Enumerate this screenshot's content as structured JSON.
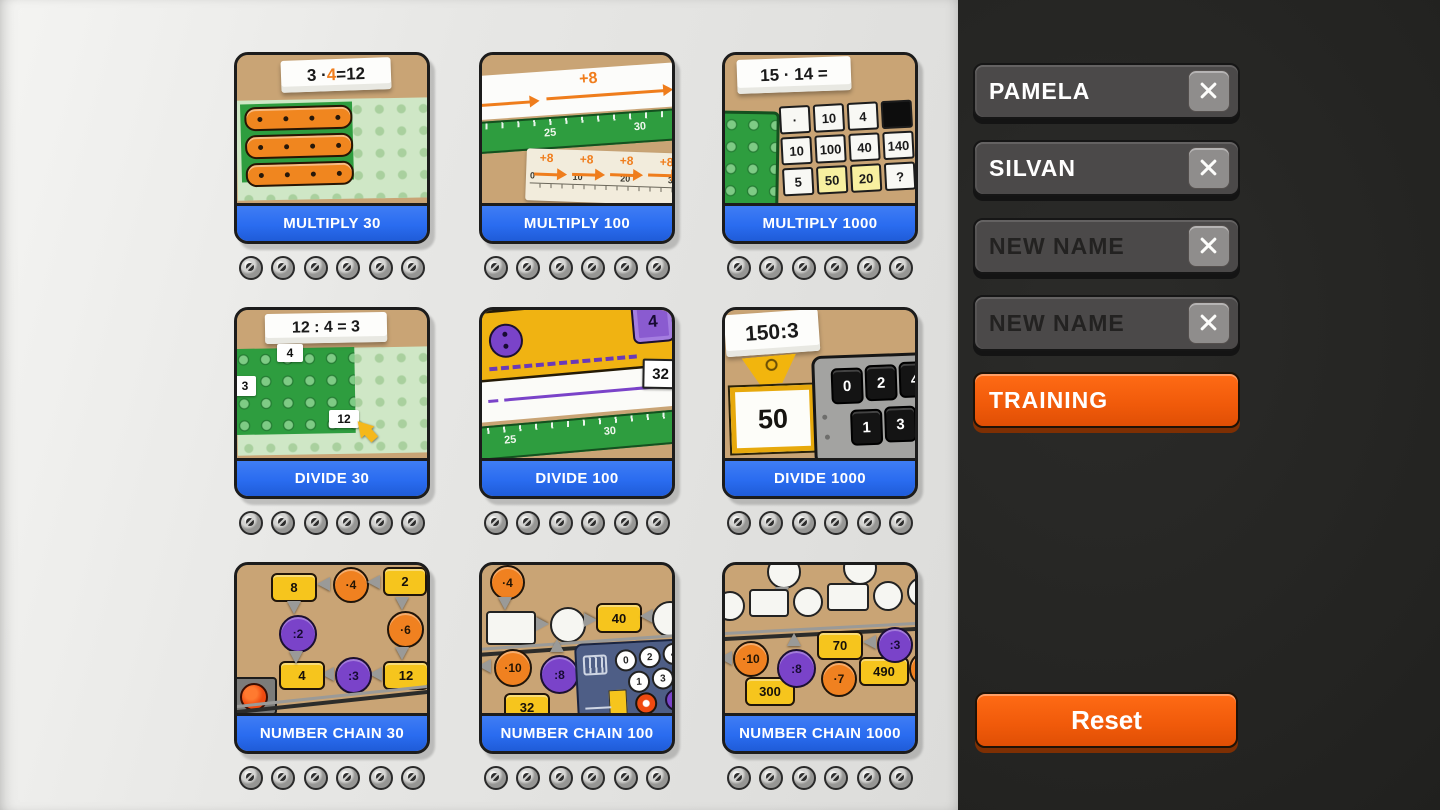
{
  "main": {
    "cards": [
      {
        "label": "MULTIPLY 30",
        "note_prefix": "3 · ",
        "note_accent": "4",
        "note_suffix": " =12"
      },
      {
        "label": "MULTIPLY 100",
        "op_label": "+8",
        "ruler_ticks": [
          "25",
          "30"
        ],
        "paper_ops": [
          "+8",
          "+8",
          "+8",
          "+8"
        ],
        "paper_ticks": [
          "0",
          "10",
          "20",
          "30"
        ]
      },
      {
        "label": "MULTIPLY 1000",
        "note": "15 · 14 =",
        "table": [
          [
            "·",
            "10",
            "4",
            ""
          ],
          [
            "10",
            "100",
            "40",
            "140"
          ],
          [
            "5",
            "50",
            "20",
            "?"
          ]
        ]
      },
      {
        "label": "DIVIDE 30",
        "note": "12 : 4 = 3",
        "tag_top": "4",
        "tag_left": "3",
        "tag_mid": "12"
      },
      {
        "label": "DIVIDE 100",
        "divisor": "4",
        "quotient": "32",
        "ruler_ticks": [
          "25",
          "30"
        ]
      },
      {
        "label": "DIVIDE 1000",
        "note": "150:3",
        "dividend": "50",
        "keys": [
          "0",
          "2",
          "4",
          "1",
          "3"
        ]
      },
      {
        "label": "NUMBER CHAIN 30",
        "boxes": [
          "8",
          "2",
          "12",
          "4"
        ],
        "ops": [
          "·4",
          "·6",
          ":2",
          ":3"
        ]
      },
      {
        "label": "NUMBER CHAIN 100",
        "ops": [
          "·4",
          "·10",
          ":8"
        ],
        "boxes": [
          "40",
          "32"
        ],
        "keys": [
          "0",
          "2",
          "4",
          "1",
          "3",
          "5"
        ]
      },
      {
        "label": "NUMBER CHAIN 1000",
        "ops": [
          "·10",
          ":8",
          "·7",
          ":3",
          "·12"
        ],
        "boxes": [
          "70",
          "490",
          "300"
        ]
      }
    ]
  },
  "sidebar": {
    "players": [
      {
        "name": "PAMELA",
        "filled": true
      },
      {
        "name": "SILVAN",
        "filled": true
      },
      {
        "name": "NEW NAME",
        "filled": false
      },
      {
        "name": "NEW NAME",
        "filled": false
      }
    ],
    "training_label": "TRAINING",
    "reset_label": "Reset",
    "close_icon": "x"
  },
  "colors": {
    "accent_orange": "#f05a0a",
    "bar_blue": "#2a6cf0",
    "card_tan": "#c9a475",
    "sidebar_bg": "#232321",
    "main_bg": "#e2e2e0",
    "button_gray": "#4b4949"
  }
}
